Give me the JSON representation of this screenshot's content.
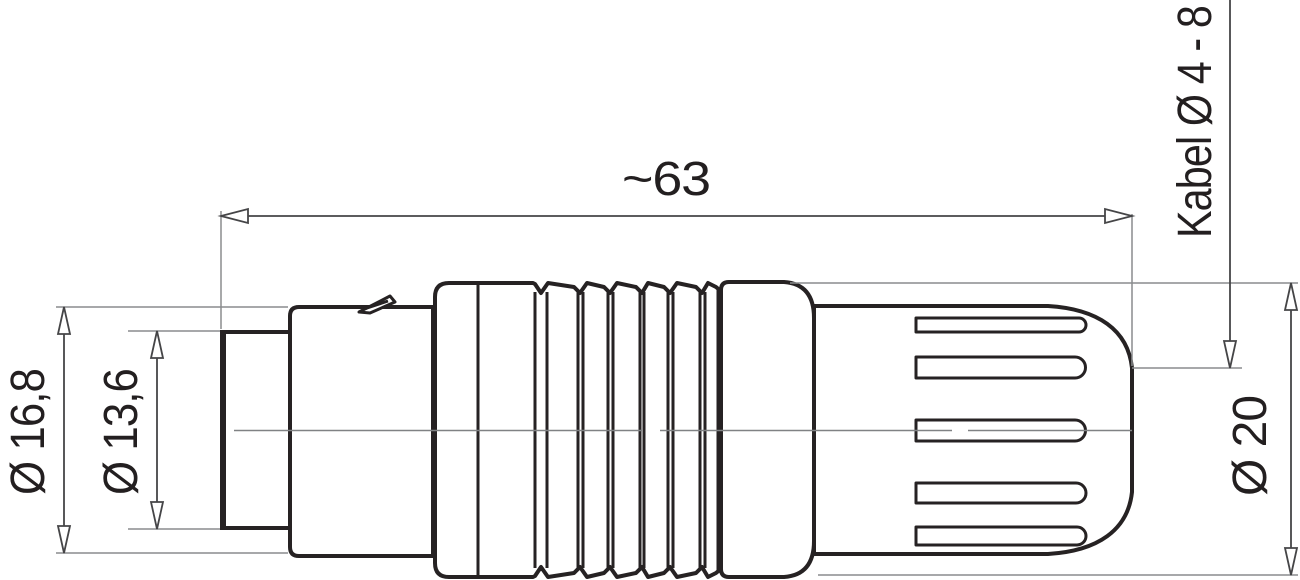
{
  "dimensions": {
    "length": {
      "label": "~63"
    },
    "outer_diameter": {
      "label": "Ø 16,8"
    },
    "inner_diameter": {
      "label": "Ø 13,6"
    },
    "body_diameter": {
      "label": "Ø 20"
    },
    "cable_diameter": {
      "label": "Kabel Ø 4 - 8"
    }
  },
  "colors": {
    "line": "#262223",
    "dimension_line": "#454547",
    "extension_line": "#8a8c8e",
    "text": "#231f20",
    "background": "#ffffff"
  }
}
